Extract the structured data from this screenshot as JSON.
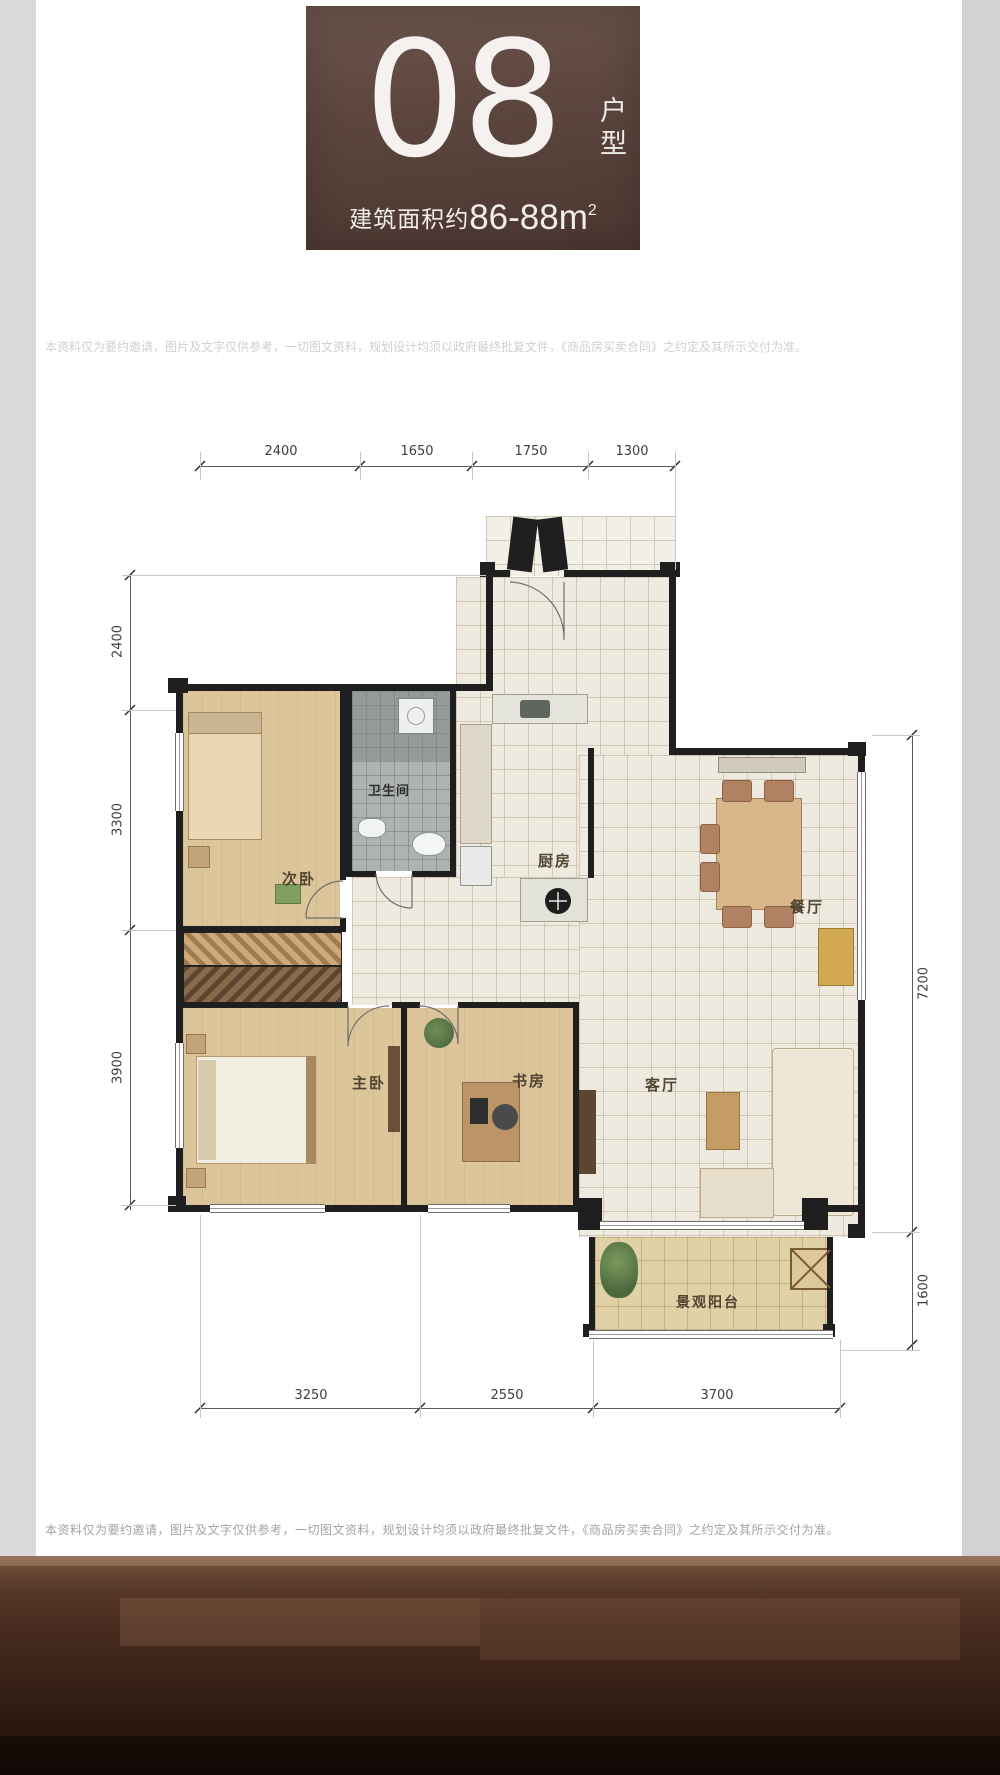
{
  "header": {
    "unit_number": "08",
    "unit_type_label": "户型",
    "area_prefix": "建筑面积约",
    "area_value": "86-88m",
    "area_exponent": "2"
  },
  "watermark_text": "本资料仅为要约邀请，图片及文字仅供参考，一切图文资料，规划设计均须以政府最终批复文件，《商品房买卖合同》之约定及其所示交付为准。",
  "floor_plan": {
    "rooms": {
      "secondary_bedroom": "次卧",
      "bathroom": "卫生间",
      "kitchen": "厨房",
      "dining_room": "餐厅",
      "master_bedroom": "主卧",
      "study": "书房",
      "living_room": "客厅",
      "balcony": "景观阳台"
    },
    "dimensions": {
      "top": [
        "2400",
        "1650",
        "1750",
        "1300"
      ],
      "left": [
        "2400",
        "3300",
        "3900"
      ],
      "right": [
        "7200",
        "1600"
      ],
      "bottom": [
        "3250",
        "2550",
        "3700"
      ]
    }
  },
  "disclaimer_text": "本资料仅为要约邀请，图片及文字仅供参考，一切图文资料，规划设计均须以政府最终批复文件，《商品房买卖合同》之约定及其所示交付为准。",
  "colors": {
    "badge_brown": "#5e4840",
    "badge_brown_dark": "#4c3630",
    "footer_brown": "#3f2a20",
    "wall_black": "#1f1f1f",
    "wood_floor": "#dcc59b",
    "tile_cream": "#eeeadf",
    "bath_gray": "#aeb3b0",
    "balcony_tan": "#e1d1a7"
  }
}
